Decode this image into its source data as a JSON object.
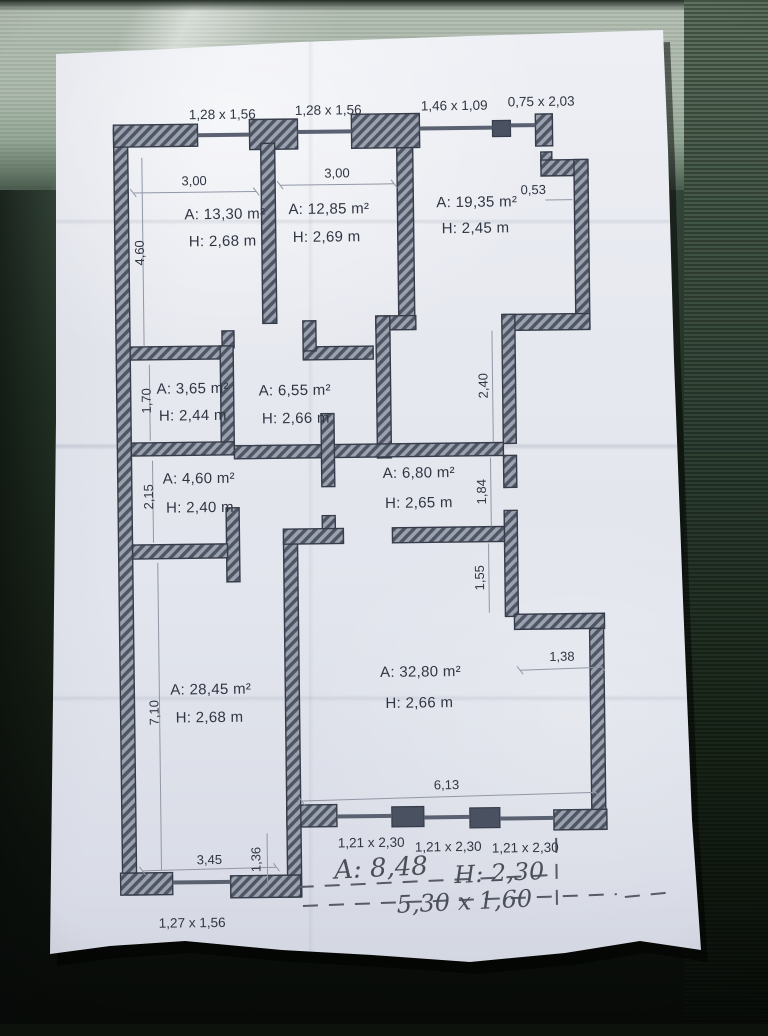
{
  "colors": {
    "paper": "#e7e9ef",
    "wall_dark": "#4e5563",
    "wall_light": "#9ba1ae",
    "ink": "#2f3542",
    "dim_line": "#9097a6",
    "handwriting": "#4b5058",
    "background_top": "#b6bfb4",
    "background_dark": "#16201a"
  },
  "plan": {
    "top_openings": [
      {
        "label": "1,28 x 1,56"
      },
      {
        "label": "1,28 x 1,56"
      },
      {
        "label": "1,46 x 1,09"
      },
      {
        "label": "0,75 x 2,03"
      }
    ],
    "rooms": [
      {
        "area": "A: 13,30 m²",
        "height": "H: 2,68 m"
      },
      {
        "area": "A: 12,85 m²",
        "height": "H: 2,69 m"
      },
      {
        "area": "A: 19,35 m²",
        "height": "H: 2,45 m"
      },
      {
        "area": "A: 3,65 m²",
        "height": "H: 2,44 m"
      },
      {
        "area": "A: 6,55 m²",
        "height": "H: 2,66 m"
      },
      {
        "area": "A: 4,60 m²",
        "height": "H: 2,40 m"
      },
      {
        "area": "A: 6,80 m²",
        "height": "H: 2,65 m"
      },
      {
        "area": "A: 28,45 m²",
        "height": "H: 2,68 m"
      },
      {
        "area": "A: 32,80 m²",
        "height": "H: 2,66 m"
      }
    ],
    "dimensions": {
      "room1_width": "3,00",
      "room2_width": "3,00",
      "step_top_right": "0,53",
      "room1_height": "4,60",
      "closet1_height": "1,70",
      "closet2_height": "2,15",
      "room8_height": "7,10",
      "right_upper": "2,40",
      "right_middle": "1,84",
      "right_lower": "1,55",
      "niche_width": "1,38",
      "room9_width": "6,13",
      "room8_width": "3,45",
      "step_bottom": "1,36"
    },
    "bottom_openings": [
      {
        "label": "1,21 x 2,30"
      },
      {
        "label": "1,21 x 2,30"
      },
      {
        "label": "1,21 x 2,30"
      },
      {
        "label": "1,27 x 1,56"
      }
    ],
    "handwritten": {
      "area": "A: 8,48",
      "height": "H: 2,30",
      "size": "5,30 x 1,60"
    }
  }
}
